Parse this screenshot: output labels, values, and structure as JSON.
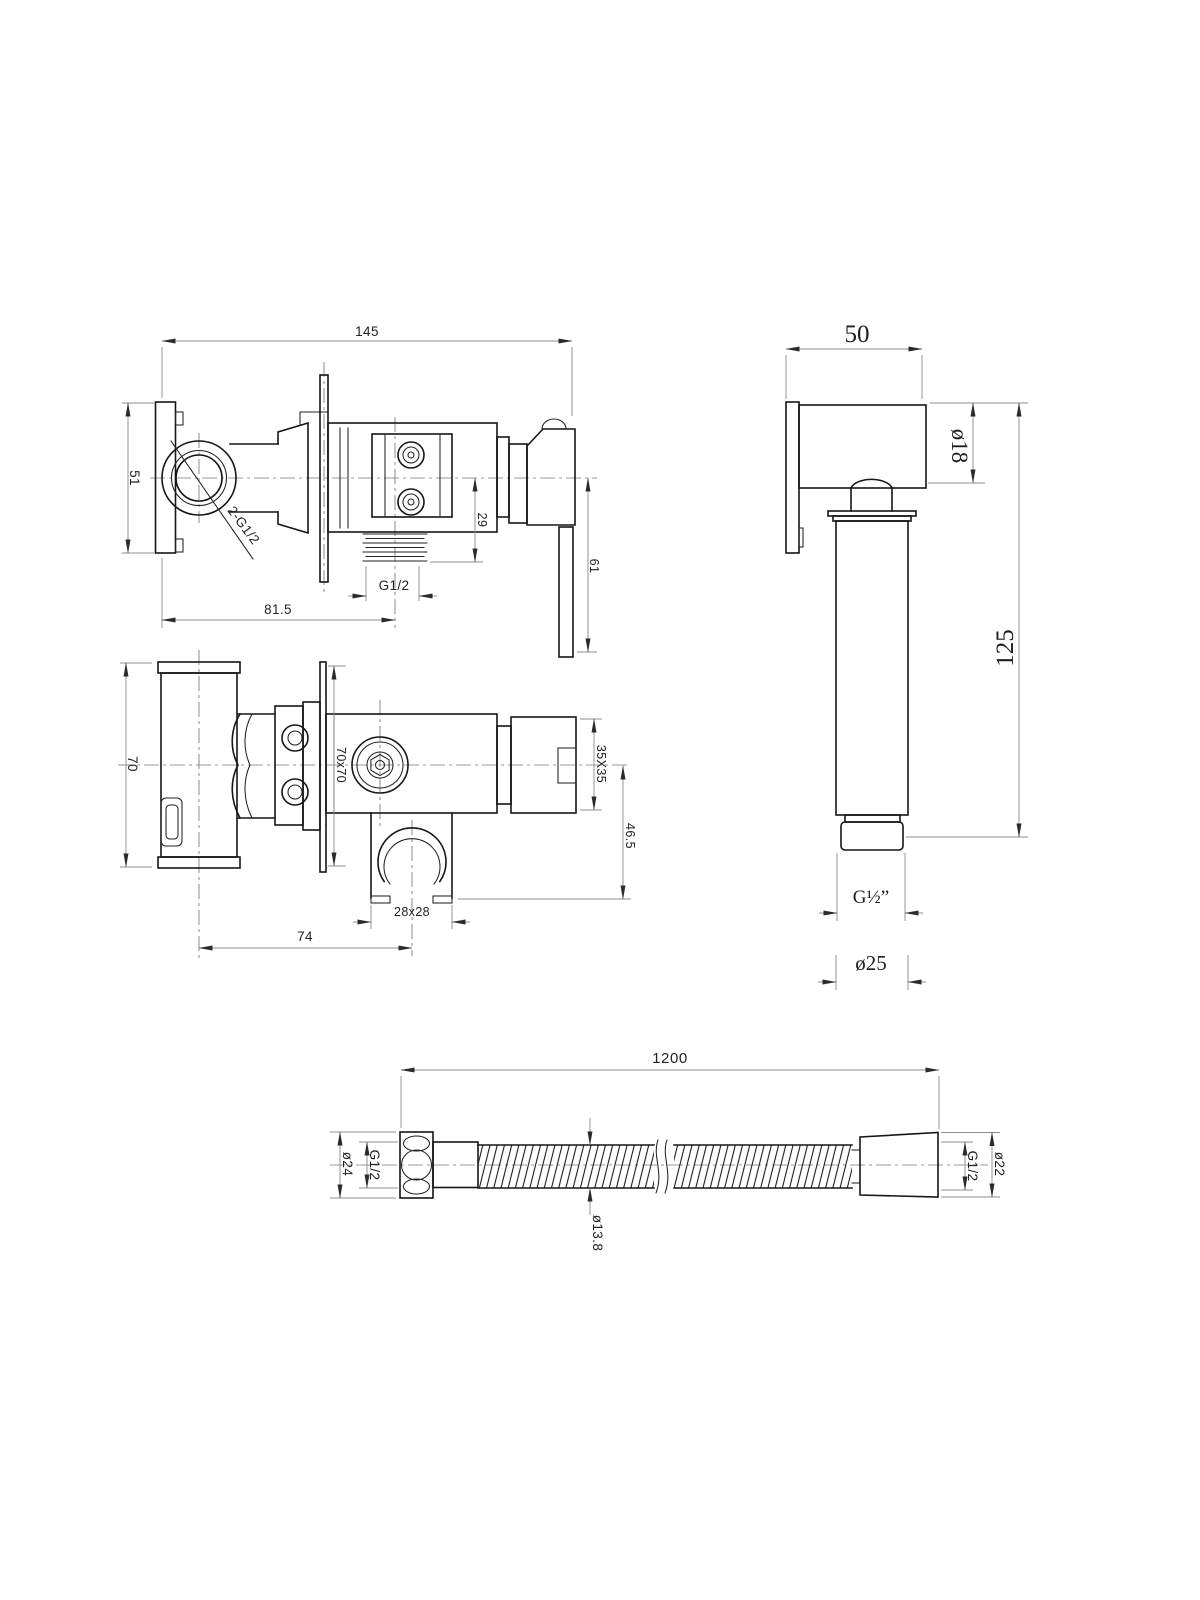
{
  "drawing": {
    "type": "technical dimension drawing",
    "subject": "bidet shower mixer set: concealed valve (side and top views), hand sprayer, flexible hose",
    "colors": {
      "background": "#ffffff",
      "object_line": "#161616",
      "dimension_line": "#8f8f8f",
      "text": "#222222"
    }
  },
  "views": {
    "side": {
      "name": "mixer-side-view",
      "dims": {
        "width": "145",
        "plate_height": "51",
        "inlet": "2-G1/2",
        "outlet_offset": "29",
        "lever": "61",
        "thread": "G1/2",
        "depth": "81.5"
      }
    },
    "sprayer": {
      "name": "hand-sprayer-view",
      "dims": {
        "head": "50",
        "head_dia": "ø18",
        "height": "125",
        "thread": "G½”",
        "body_dia": "ø25"
      }
    },
    "top": {
      "name": "mixer-top-view",
      "dims": {
        "body": "70",
        "plate": "70x70",
        "handle": "35X35",
        "holder_offset": "46.5",
        "holder": "28x28",
        "spacing": "74"
      }
    },
    "hose": {
      "name": "hose-view",
      "dims": {
        "length": "1200",
        "nut_dia": "ø24",
        "nut_thread": "G1/2",
        "dia": "ø13.8",
        "fitting_thread": "G1/2",
        "fitting_dia": "ø22"
      }
    }
  }
}
